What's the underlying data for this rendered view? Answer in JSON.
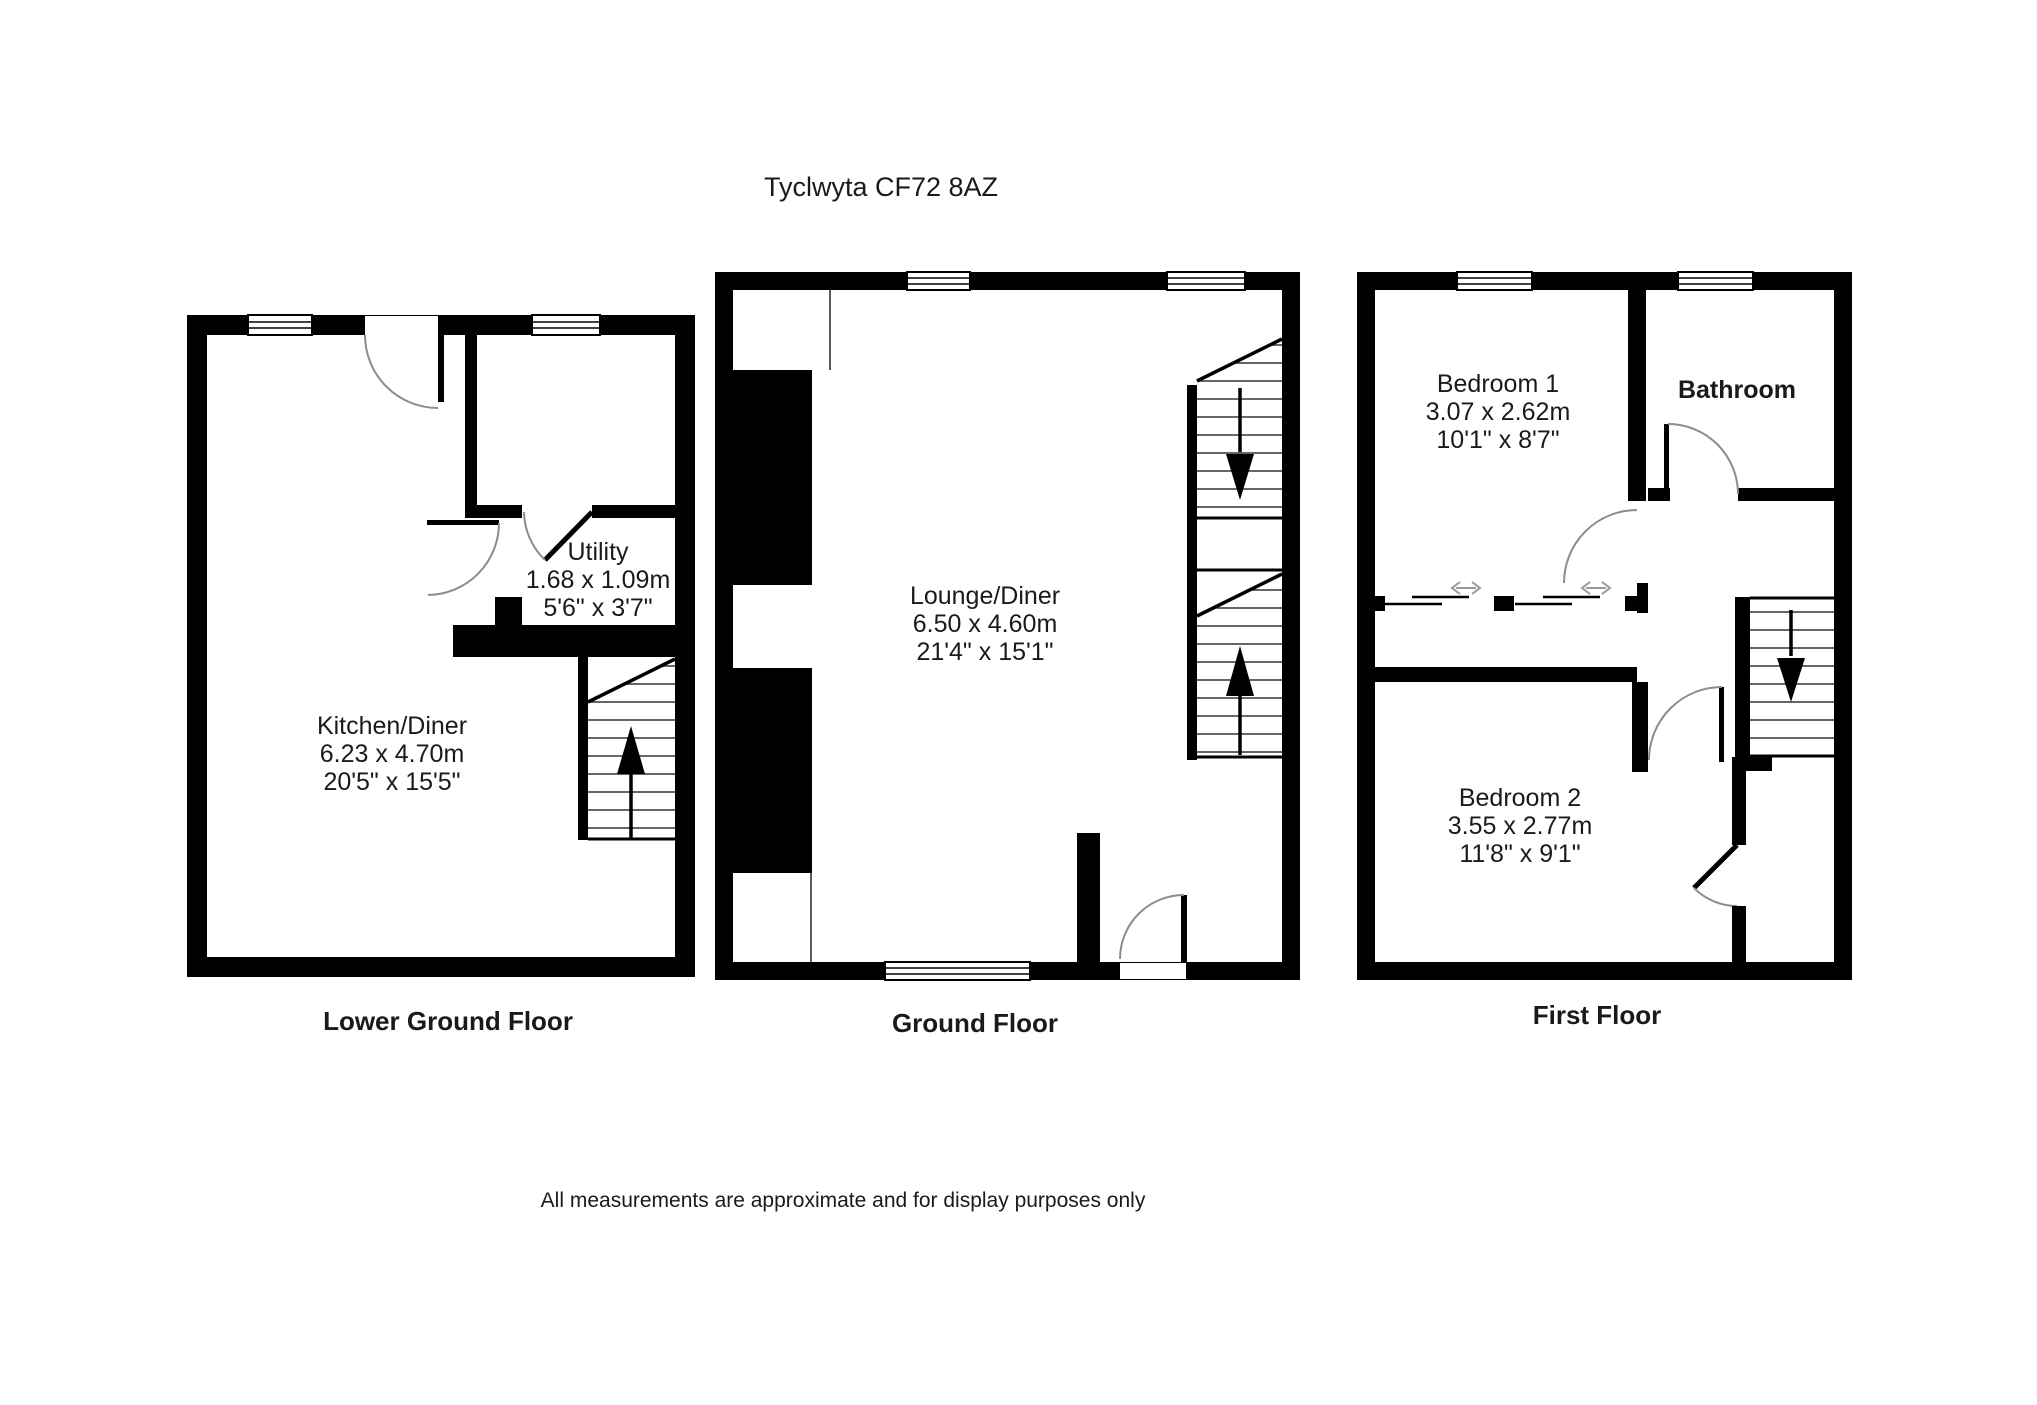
{
  "title": "Tyclwyta CF72 8AZ",
  "disclaimer": "All measurements are approximate and for display purposes only",
  "plans": [
    {
      "caption": "Lower Ground Floor",
      "rooms": [
        {
          "name": "Kitchen/Diner",
          "metric": "6.23 x 4.70m",
          "imperial": "20'5\" x 15'5\""
        },
        {
          "name": "Utility",
          "metric": "1.68 x 1.09m",
          "imperial": "5'6\" x 3'7\""
        }
      ]
    },
    {
      "caption": "Ground Floor",
      "rooms": [
        {
          "name": "Lounge/Diner",
          "metric": "6.50 x 4.60m",
          "imperial": "21'4\" x 15'1\""
        }
      ]
    },
    {
      "caption": "First Floor",
      "rooms": [
        {
          "name": "Bedroom 1",
          "metric": "3.07 x 2.62m",
          "imperial": "10'1\" x 8'7\""
        },
        {
          "name": "Bathroom"
        },
        {
          "name": "Bedroom 2",
          "metric": "3.55 x 2.77m",
          "imperial": "11'8\" x 9'1\""
        }
      ]
    }
  ],
  "stairs": [
    {
      "floor": "Lower Ground Floor",
      "direction": "up"
    },
    {
      "floor": "Ground Floor",
      "direction": "down-and-up"
    },
    {
      "floor": "First Floor",
      "direction": "down"
    }
  ],
  "colors": {
    "wall": "#000000",
    "background": "#ffffff",
    "door_arc": "#8c8c8c",
    "stair_tread": "#333333",
    "slide_arrow": "#999999",
    "text": "#1a1a1a"
  }
}
